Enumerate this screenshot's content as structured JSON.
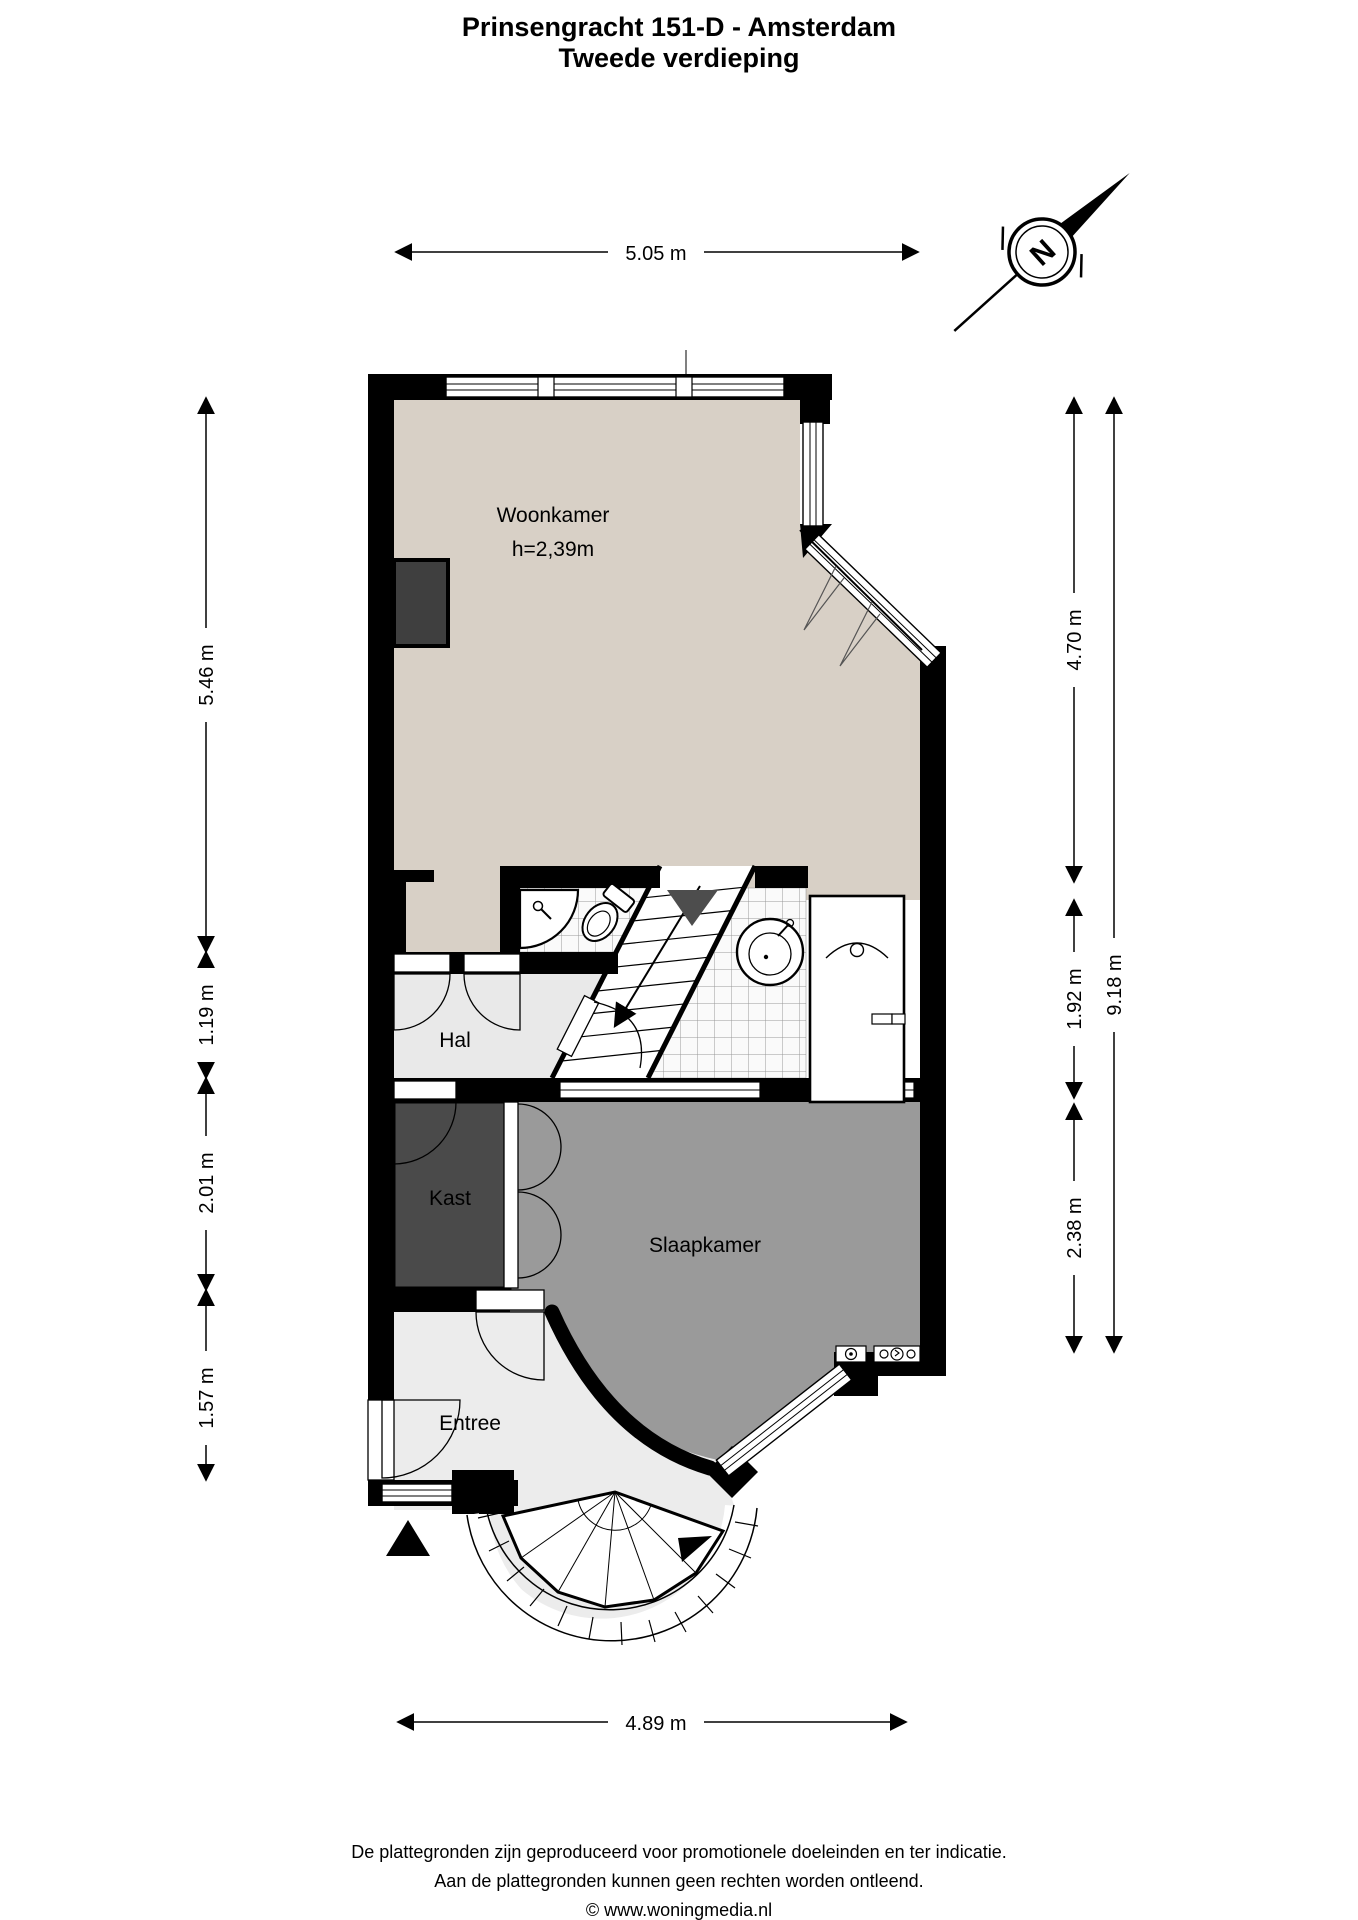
{
  "title": {
    "line1": "Prinsengracht 151-D - Amsterdam",
    "line2": "Tweede verdieping"
  },
  "compass": {
    "label": "N"
  },
  "rooms": {
    "woonkamer": {
      "label": "Woonkamer",
      "height_note": "h=2,39m"
    },
    "hal": {
      "label": "Hal"
    },
    "kast": {
      "label": "Kast"
    },
    "slaapkamer": {
      "label": "Slaapkamer"
    },
    "entree": {
      "label": "Entree"
    }
  },
  "dimensions": {
    "top": "5.05 m",
    "bottom": "4.89 m",
    "left": [
      "5.46 m",
      "1.19 m",
      "2.01 m",
      "1.57 m"
    ],
    "right_inner": [
      "4.70 m",
      "1.92 m",
      "2.38 m"
    ],
    "right_outer": "9.18 m"
  },
  "footer": {
    "line1": "De plattegronden zijn geproduceerd voor promotionele doeleinden en ter indicatie.",
    "line2": "Aan de plattegronden kunnen geen rechten worden ontleend.",
    "line3": "© www.woningmedia.nl"
  },
  "colors": {
    "wall": "#000000",
    "woonkamer_fill": "#d8d0c6",
    "slaapkamer_fill": "#9a9a9a",
    "hal_fill": "#e9e9e9",
    "entree_fill": "#ececec",
    "kast_fill": "#4a4a4a",
    "tile_line": "#999999"
  }
}
